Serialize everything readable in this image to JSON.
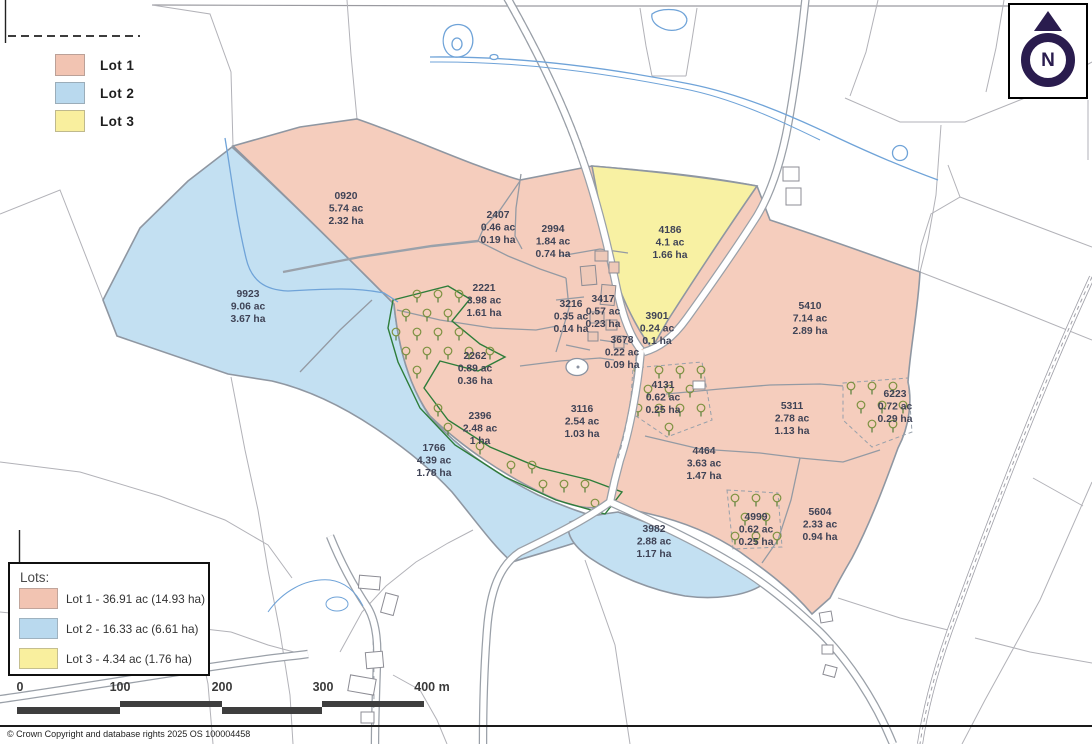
{
  "colors": {
    "lot1": "#f5cdbd",
    "lot2": "#c3e0f2",
    "lot3": "#f8f1a3"
  },
  "legend": {
    "items": [
      {
        "label": "Lot 1",
        "color": "#f2c4b2"
      },
      {
        "label": "Lot 2",
        "color": "#b9d9ee"
      },
      {
        "label": "Lot 3",
        "color": "#f9ef9e"
      }
    ]
  },
  "north_arrow": {
    "label": "N"
  },
  "lots_panel": {
    "title": "Lots:",
    "items": [
      {
        "label": "Lot 1 - 36.91 ac (14.93 ha)",
        "color": "#f2c4b2"
      },
      {
        "label": "Lot 2 - 16.33 ac (6.61 ha)",
        "color": "#b9d9ee"
      },
      {
        "label": "Lot 3 - 4.34 ac (1.76 ha)",
        "color": "#f9ef9e"
      }
    ]
  },
  "scale_bar": {
    "ticks": [
      "0",
      "100",
      "200",
      "300",
      "400 m"
    ]
  },
  "copyright": "© Crown Copyright and database rights 2025 OS 100004458",
  "parcels": [
    {
      "id": "0920",
      "ac": "5.74 ac",
      "ha": "2.32 ha",
      "lot": 1,
      "x": 346,
      "y": 207
    },
    {
      "id": "2407",
      "ac": "0.46 ac",
      "ha": "0.19 ha",
      "lot": 1,
      "x": 498,
      "y": 226
    },
    {
      "id": "2994",
      "ac": "1.84 ac",
      "ha": "0.74 ha",
      "lot": 1,
      "x": 553,
      "y": 240
    },
    {
      "id": "4186",
      "ac": "4.1 ac",
      "ha": "1.66 ha",
      "lot": 3,
      "x": 670,
      "y": 241
    },
    {
      "id": "9923",
      "ac": "9.06 ac",
      "ha": "3.67 ha",
      "lot": 2,
      "x": 248,
      "y": 305
    },
    {
      "id": "2221",
      "ac": "3.98 ac",
      "ha": "1.61 ha",
      "lot": 1,
      "x": 484,
      "y": 299
    },
    {
      "id": "3216",
      "ac": "0.35 ac",
      "ha": "0.14 ha",
      "lot": 1,
      "x": 571,
      "y": 315
    },
    {
      "id": "3417",
      "ac": "0.57 ac",
      "ha": "0.23 ha",
      "lot": 1,
      "x": 603,
      "y": 310
    },
    {
      "id": "3901",
      "ac": "0.24 ac",
      "ha": "0.1 ha",
      "lot": 3,
      "x": 657,
      "y": 327
    },
    {
      "id": "3678",
      "ac": "0.22 ac",
      "ha": "0.09 ha",
      "lot": 1,
      "x": 622,
      "y": 351
    },
    {
      "id": "5410",
      "ac": "7.14 ac",
      "ha": "2.89 ha",
      "lot": 1,
      "x": 810,
      "y": 317
    },
    {
      "id": "2262",
      "ac": "0.89 ac",
      "ha": "0.36 ha",
      "lot": 1,
      "x": 475,
      "y": 367
    },
    {
      "id": "4131",
      "ac": "0.62 ac",
      "ha": "0.25 ha",
      "lot": 1,
      "x": 663,
      "y": 396
    },
    {
      "id": "2396",
      "ac": "2.48 ac",
      "ha": "1 ha",
      "lot": 1,
      "x": 480,
      "y": 427
    },
    {
      "id": "3116",
      "ac": "2.54 ac",
      "ha": "1.03 ha",
      "lot": 1,
      "x": 582,
      "y": 420
    },
    {
      "id": "5311",
      "ac": "2.78 ac",
      "ha": "1.13 ha",
      "lot": 1,
      "x": 792,
      "y": 417
    },
    {
      "id": "6223",
      "ac": "0.72 ac",
      "ha": "0.29 ha",
      "lot": 1,
      "x": 895,
      "y": 405
    },
    {
      "id": "1766",
      "ac": "4.39 ac",
      "ha": "1.78 ha",
      "lot": 2,
      "x": 434,
      "y": 459
    },
    {
      "id": "4464",
      "ac": "3.63 ac",
      "ha": "1.47 ha",
      "lot": 1,
      "x": 704,
      "y": 462
    },
    {
      "id": "4999",
      "ac": "0.62 ac",
      "ha": "0.25 ha",
      "lot": 1,
      "x": 756,
      "y": 528
    },
    {
      "id": "5604",
      "ac": "2.33 ac",
      "ha": "0.94 ha",
      "lot": 1,
      "x": 820,
      "y": 523
    },
    {
      "id": "3982",
      "ac": "2.88 ac",
      "ha": "1.17 ha",
      "lot": 2,
      "x": 654,
      "y": 540
    }
  ]
}
